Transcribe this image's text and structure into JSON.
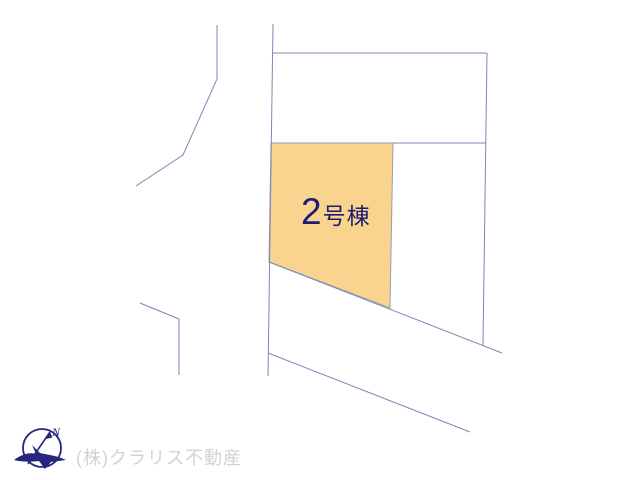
{
  "map": {
    "background": "#ffffff",
    "line_color": "#8484b6",
    "lines": [
      {
        "name": "road-edge-upper-left",
        "points": "217,25 217,79 183,155 136,186"
      },
      {
        "name": "road-edge-lower-left",
        "points": "140,303 179,319 179,375"
      },
      {
        "name": "site-west-boundary",
        "points": "273,24 268,376"
      },
      {
        "name": "site-north-boundary",
        "points": "273,53 487,53"
      },
      {
        "name": "site-east-boundary",
        "points": "487,53 483,345"
      },
      {
        "name": "inner-boundary-horizontal",
        "points": "393,143 486,143"
      },
      {
        "name": "road-diagonal-upper",
        "points": "269,262 502,353"
      },
      {
        "name": "road-diagonal-lower",
        "points": "268,353 470,432"
      }
    ],
    "polygons": [
      {
        "name": "lot-2-parcel",
        "points": "271,143 393,143 390,308 269,262",
        "fill": "#F8D48E",
        "stroke": "#9b9bb0"
      }
    ]
  },
  "parcel": {
    "label": "2号棟",
    "label_prefix": "2",
    "label_suffix": "号棟",
    "fill": "#F8D48E",
    "text_color": "#1d1d72"
  },
  "compass": {
    "label": "N",
    "color": "#26267c"
  },
  "watermark": {
    "company": "(株)クラリス不動産",
    "color": "#d2d2d2"
  }
}
